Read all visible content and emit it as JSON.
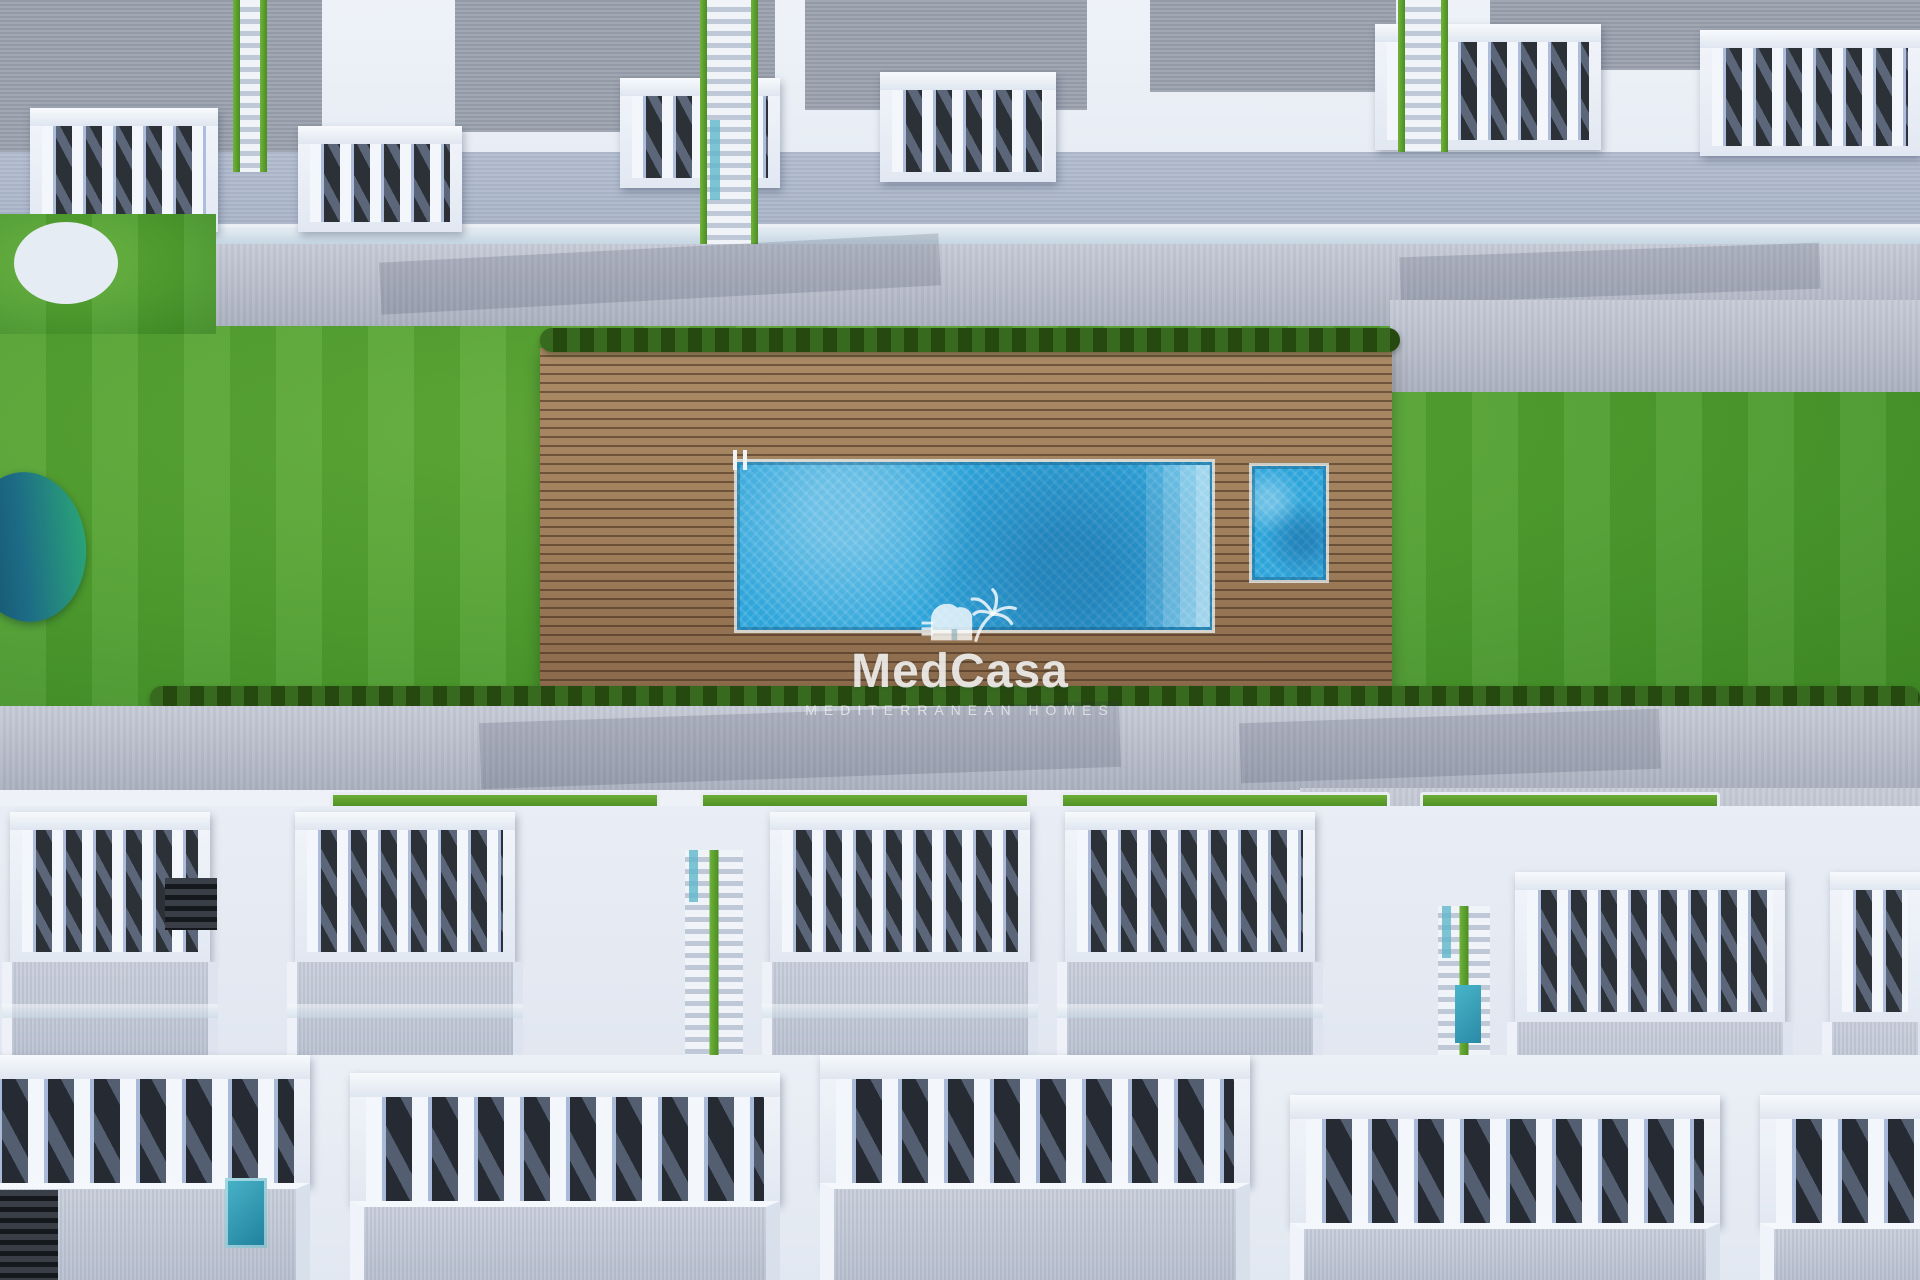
{
  "watermark": {
    "title": "MedCasa",
    "subtitle": "MEDITERRANEAN HOMES",
    "logo": "palm-house-logo"
  },
  "scene": {
    "type": "aerial-3d-architectural-render",
    "setting": "new-build residential complex, top-down view",
    "features": [
      "roof-terraces",
      "white-townhouse-rows",
      "balconies-with-slatted-railings",
      "pedestrian-promenade",
      "communal-lawn",
      "teal-pond",
      "outdoor-gym-equipment",
      "wooden-pool-deck",
      "main-swimming-pool",
      "kids-pool",
      "pool-ladder",
      "sun-loungers",
      "swimmers",
      "palm-trees",
      "hedges",
      "splash-pads",
      "sand-playground",
      "flowering-bush",
      "street-lamps",
      "parasol",
      "staircases-between-houses"
    ]
  },
  "colors": {
    "lawn": "#4f9e2f",
    "lawn_dark": "#3f8a25",
    "lawn_light": "#62ad39",
    "pool_water": "#2ea5da",
    "pool_light": "#7bcdf0",
    "pool_dark": "#1d85bb",
    "deck_wood": "#a07f5c",
    "deck_dark": "#6e5239",
    "road": "#abb1bf",
    "road_light": "#c7ccd7",
    "building_white": "#eef2f8",
    "building_shade": "#c4cfe3",
    "balcony_interior": "#2c3138",
    "roof_gray": "#9aa1ad",
    "hedge_green": "#2f5c1f",
    "palm_green": "#4f962c",
    "pond_teal": "#1d6b86",
    "pond_green": "#2aa378",
    "sand": "#e7dfc9",
    "umbrella_teal": "#4e9182",
    "equipment_wood": "#c8a24a",
    "watermark_white": "#ffffff"
  }
}
